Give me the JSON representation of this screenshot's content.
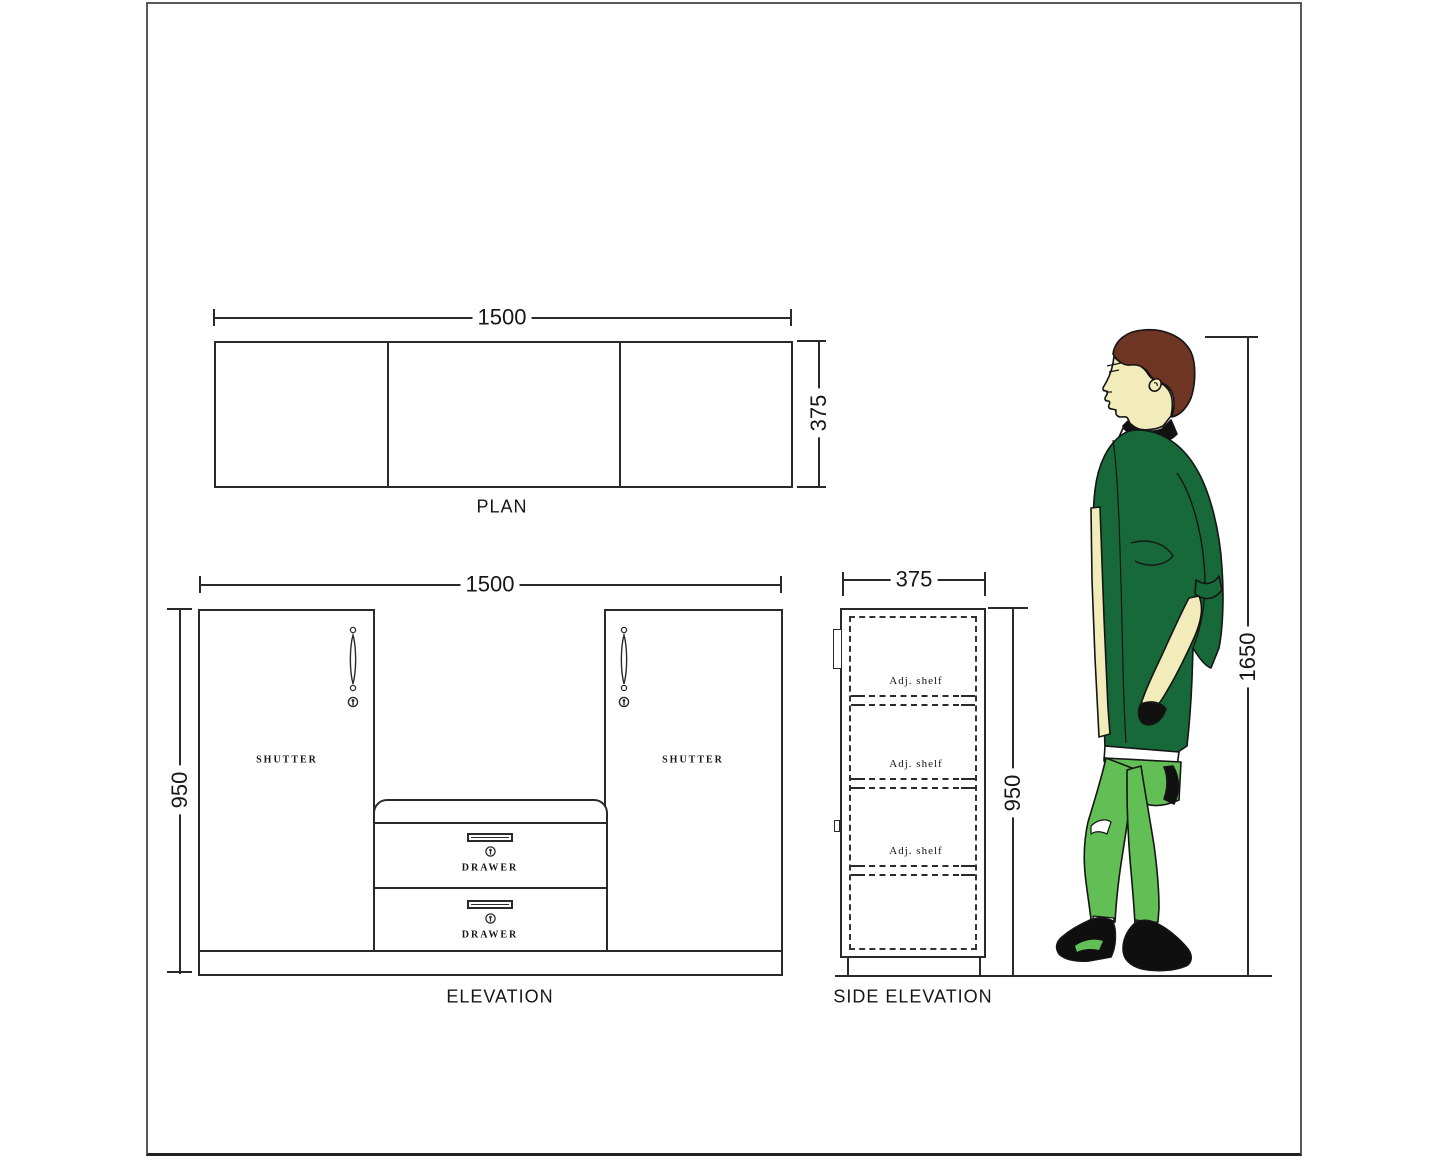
{
  "views": {
    "plan": {
      "label": "PLAN",
      "width_dim": "1500",
      "depth_dim": "375"
    },
    "elevation": {
      "label": "ELEVATION",
      "width_dim": "1500",
      "height_dim": "950",
      "shutter_left": "SHUTTER",
      "shutter_right": "SHUTTER",
      "drawer_top": "DRAWER",
      "drawer_bottom": "DRAWER"
    },
    "side": {
      "label": "SIDE ELEVATION",
      "width_dim": "375",
      "height_dim": "950",
      "shelves": [
        "Adj. shelf",
        "Adj. shelf",
        "Adj. shelf"
      ]
    },
    "figure": {
      "height_dim": "1650"
    }
  },
  "colors": {
    "line": "#2a2a2a",
    "hair": "#6e3424",
    "skin": "#f1ecba",
    "shirt": "#17693a",
    "pants": "#62bf55",
    "shoe": "#0f0f0f"
  }
}
